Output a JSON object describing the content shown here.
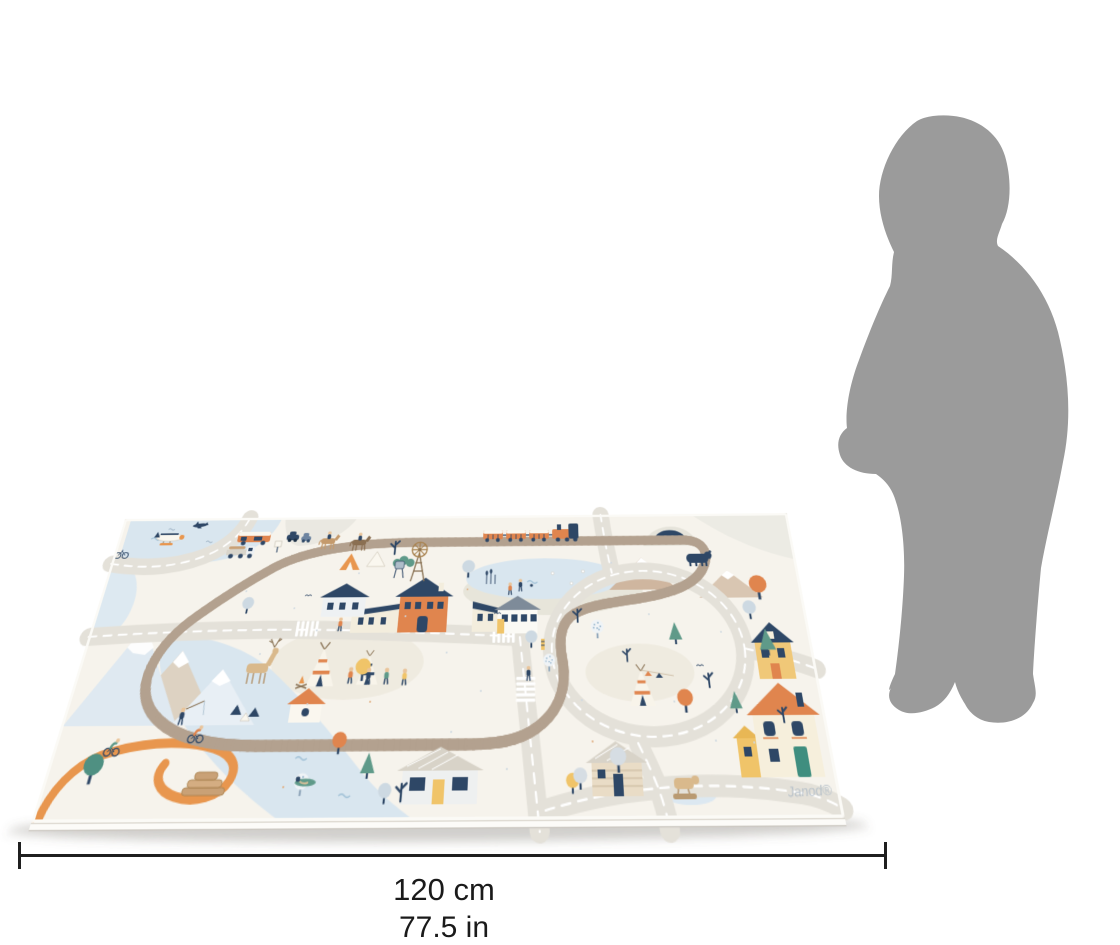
{
  "figure": {
    "type": "product-size-illustration",
    "brand_label": "Janod®",
    "dimension": {
      "value_cm": "120 cm",
      "value_in": "77.5 in"
    },
    "mat": {
      "description": "illustrated village road and railway children's play mat shown in perspective"
    },
    "silhouette": {
      "description": "toddler silhouette standing for scale",
      "color": "#9b9b9b"
    },
    "palette": {
      "background": "#ffffff",
      "mat_base": "#f6f3ec",
      "water": "#d9e6ef",
      "road": "#e4e1d9",
      "road_dash": "#ffffff",
      "track": "#b3a18f",
      "navy": "#2e4766",
      "orange": "#e0854e",
      "amber": "#f0c469",
      "teal": "#5f9a89",
      "trail_orange": "#e8964e",
      "mountain_blue": "#dfe9f1",
      "mountain_tan": "#cfb69f",
      "wood_tan": "#c9a176",
      "gray_zone": "#ecebe4",
      "silhouette_gray": "#9b9b9b",
      "dimension_line": "#1f1f1f",
      "brand_text": "#b6c0c9"
    },
    "scene_elements": [
      "play-mat",
      "child-silhouette",
      "train-icon",
      "train-track-icon",
      "road-network-icon",
      "road-loop-icon",
      "windmill-icon",
      "water-tower-icon",
      "pond-icon",
      "river-icon",
      "lake-icon",
      "mountains-icon",
      "bear-icon",
      "cave-icon",
      "deer-icon",
      "teepee-icon",
      "tents-icon",
      "campfire-icon",
      "station-house-icon",
      "houses-icon",
      "log-cabin-icon",
      "logs-icon",
      "camper-van-icon",
      "truck-icon",
      "cars-icon",
      "horse-riders-icon",
      "hikers-icon",
      "cyclists-icon",
      "fisherman-icon",
      "swimmer-icon",
      "crosswalk-icon",
      "trees-icon",
      "orange-trail-icon",
      "seaplane-icon",
      "airplane-icon",
      "bicycle-icon",
      "geese-icon"
    ]
  }
}
